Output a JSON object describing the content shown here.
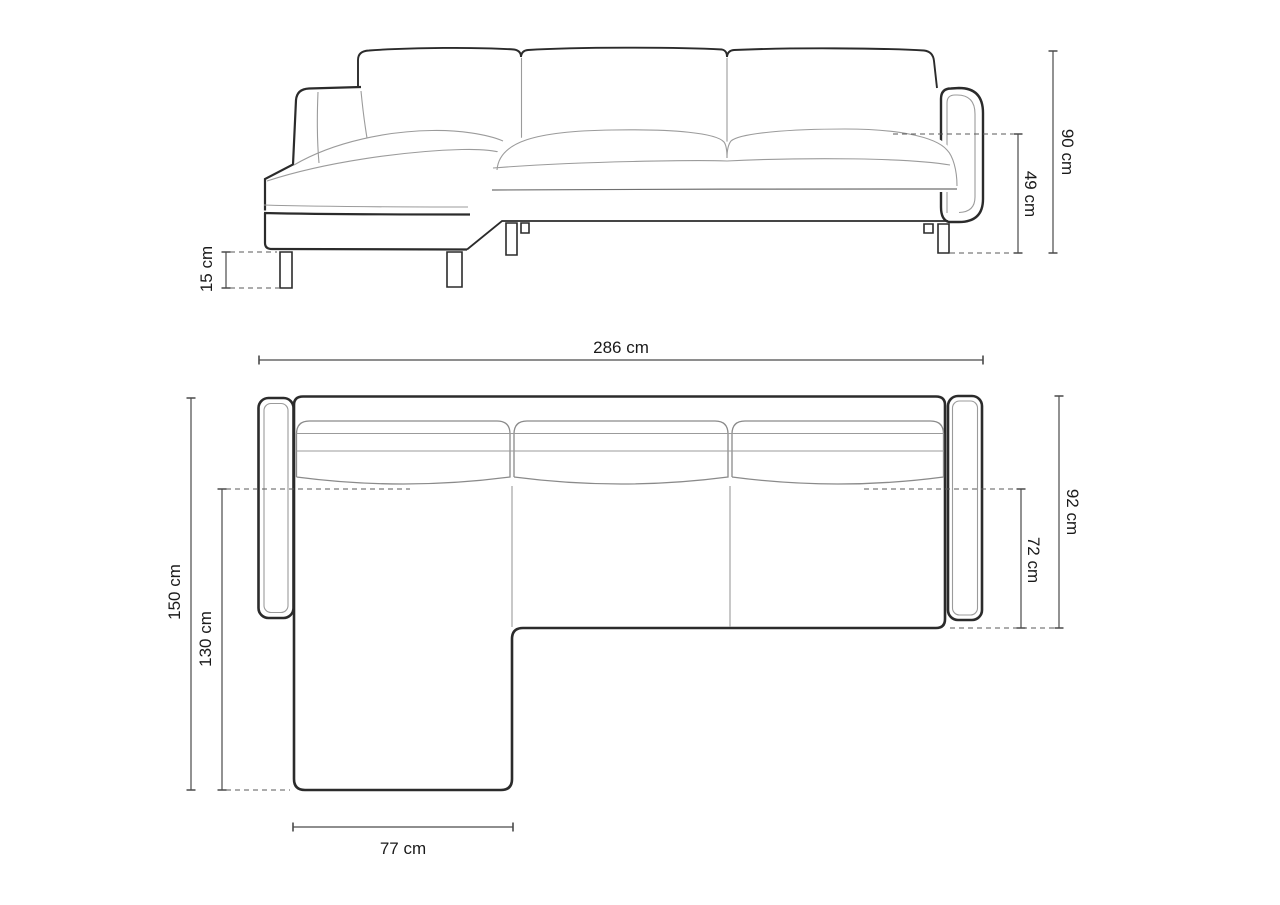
{
  "dimensions": {
    "total_width": "286 cm",
    "total_height": "90 cm",
    "seat_height": "49 cm",
    "leg_height": "15 cm",
    "total_depth": "150 cm",
    "chaise_depth": "130 cm",
    "body_depth": "92 cm",
    "seat_depth": "72 cm",
    "chaise_width": "77 cm"
  },
  "unit": "cm",
  "colors": {
    "background": "#ffffff",
    "outline_dark": "#2b2b2b",
    "seam_gray": "#9b9b9b",
    "dimension_line": "#4a4a4a",
    "label_text": "#1a1a1a"
  }
}
